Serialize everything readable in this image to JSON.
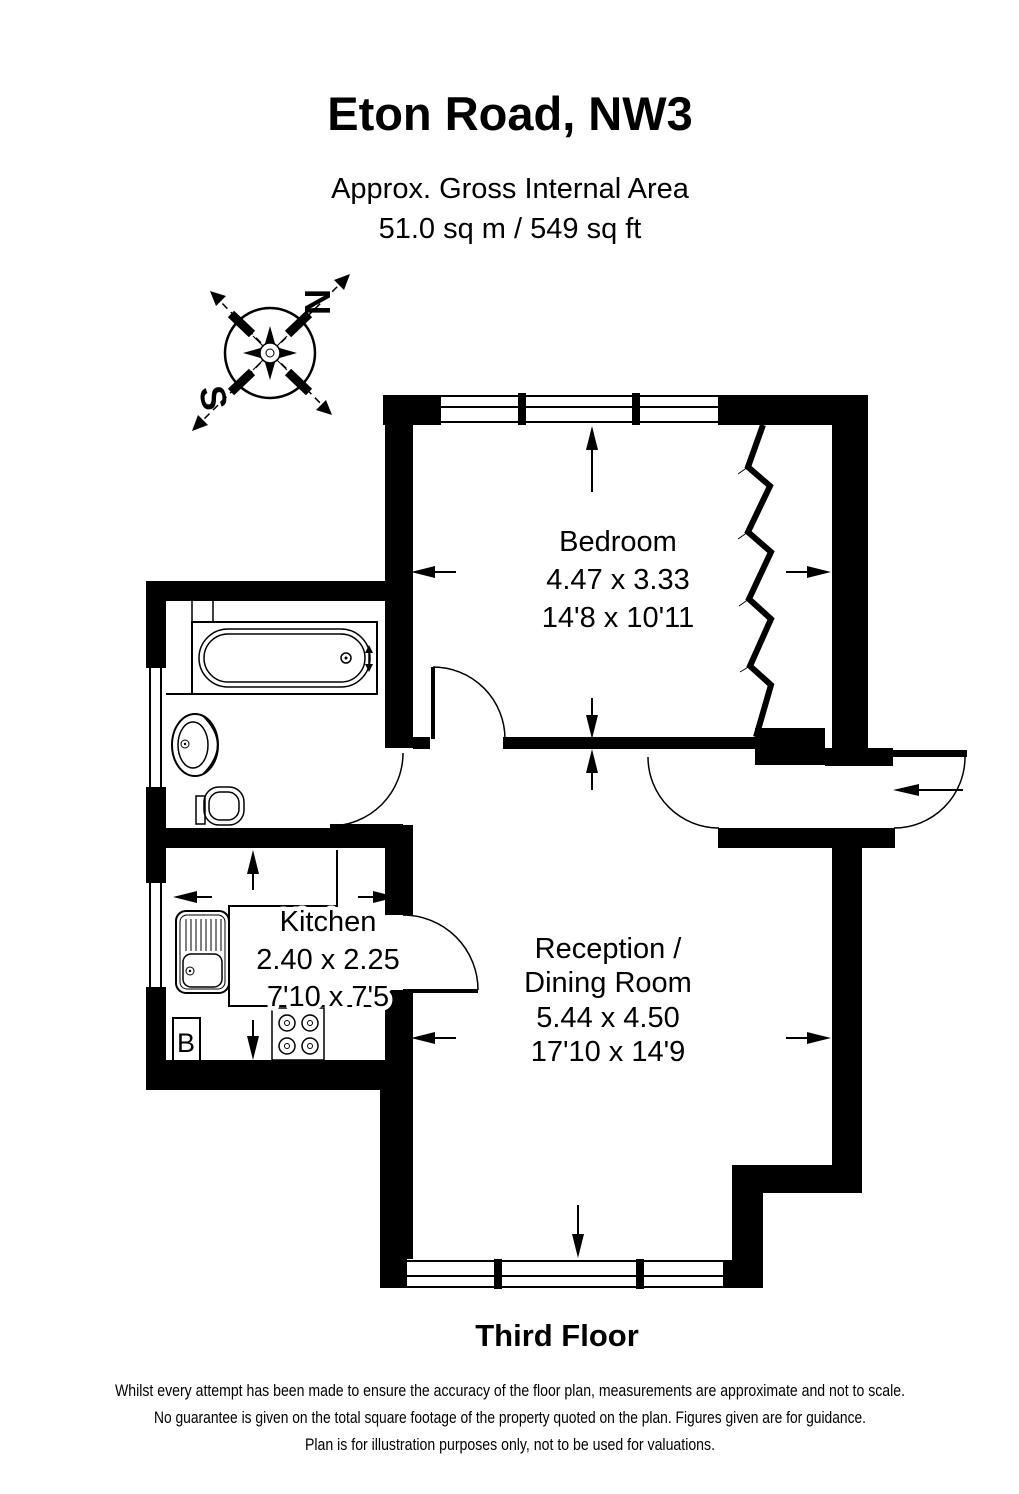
{
  "header": {
    "title": "Eton Road, NW3",
    "area_line1": "Approx. Gross Internal Area",
    "area_line2": "51.0 sq m / 549 sq ft"
  },
  "compass": {
    "north_label": "N",
    "south_label": "S"
  },
  "rooms": {
    "bedroom": {
      "name": "Bedroom",
      "dims_metric": "4.47 x 3.33",
      "dims_imperial": "14'8 x 10'11"
    },
    "kitchen": {
      "name": "Kitchen",
      "dims_metric": "2.40 x 2.25",
      "dims_imperial": "7'10 x 7'5"
    },
    "reception": {
      "name_line1": "Reception /",
      "name_line2": "Dining Room",
      "dims_metric": "5.44 x 4.50",
      "dims_imperial": "17'10 x 14'9"
    }
  },
  "labels": {
    "boiler": "B"
  },
  "footer": {
    "floor": "Third Floor",
    "disclaimer_line1": "Whilst every attempt has been made to ensure the accuracy of the floor plan, measurements are approximate and not to scale.",
    "disclaimer_line2": "No guarantee is given on the total square footage of the property quoted on the plan. Figures given are for guidance.",
    "disclaimer_line3": "Plan is for illustration purposes only, not to be used for valuations."
  },
  "colors": {
    "ink": "#000000",
    "background": "#ffffff"
  }
}
